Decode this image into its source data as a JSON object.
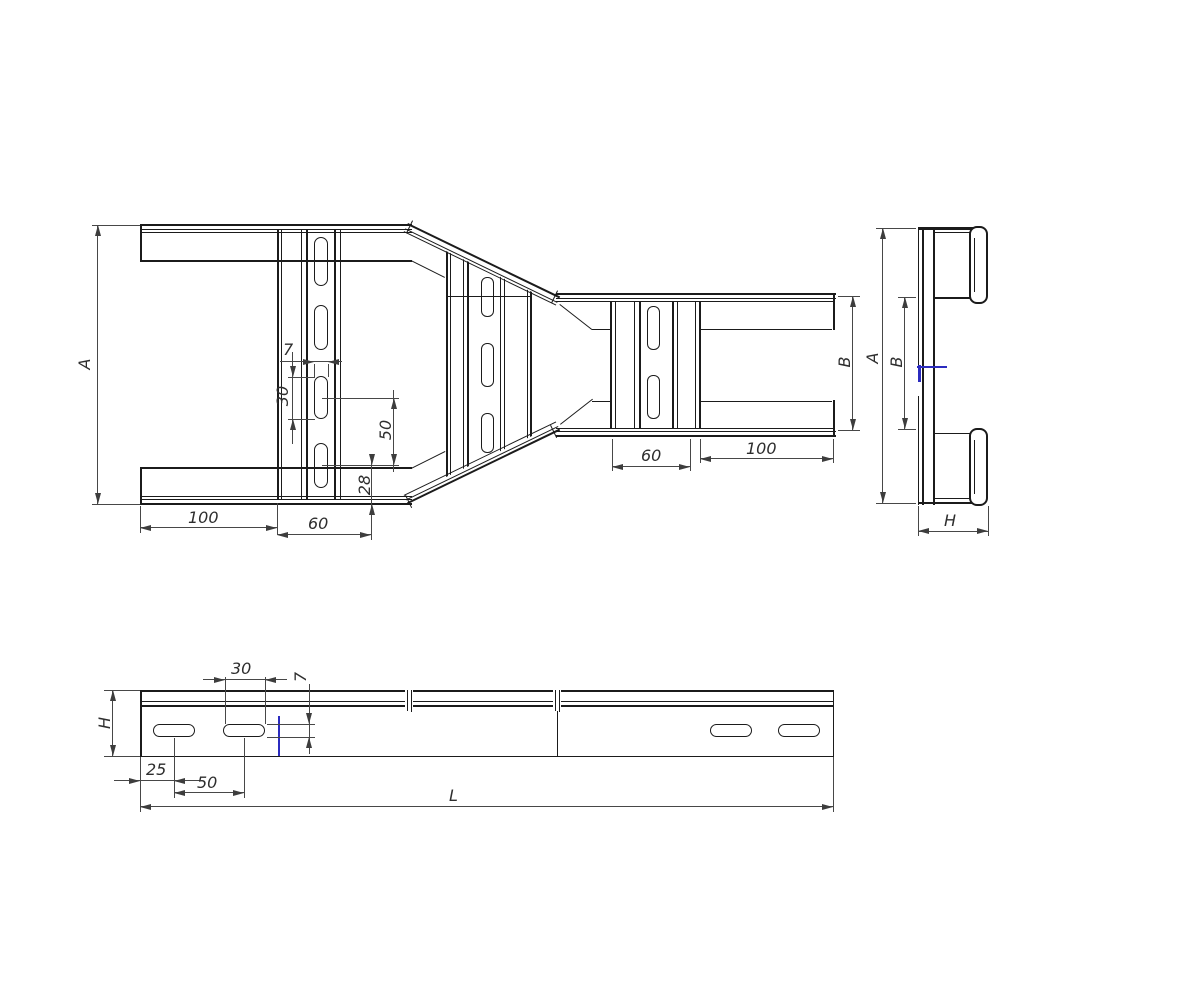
{
  "drawing": {
    "type": "technical-drawing",
    "subject": "ladder-cable-tray-reducer",
    "plan_view": {
      "dim_overall_width": "A",
      "dim_slot_width": "7",
      "dim_slot_length": "30",
      "dim_slot_pitch": "50",
      "dim_slot_to_edge": "28",
      "dim_end_to_rung": "100",
      "dim_rung_zone_width": "60",
      "dim_narrow_rung_zone_width": "60",
      "dim_narrow_rung_to_end": "100",
      "dim_narrow_width": "B"
    },
    "end_view": {
      "dim_overall_width": "A",
      "dim_inner_width": "B",
      "dim_side_height": "H"
    },
    "side_view": {
      "dim_slot_length": "30",
      "dim_slot_height": "7",
      "dim_side_height": "H",
      "dim_end_to_first_slot": "25",
      "dim_slot_pitch": "50",
      "dim_overall_length": "L"
    },
    "colors": {
      "object_line": "#1b1b1b",
      "dimension_line": "#474747",
      "highlight_blue": "#2b2bbf",
      "background": "#ffffff"
    }
  }
}
